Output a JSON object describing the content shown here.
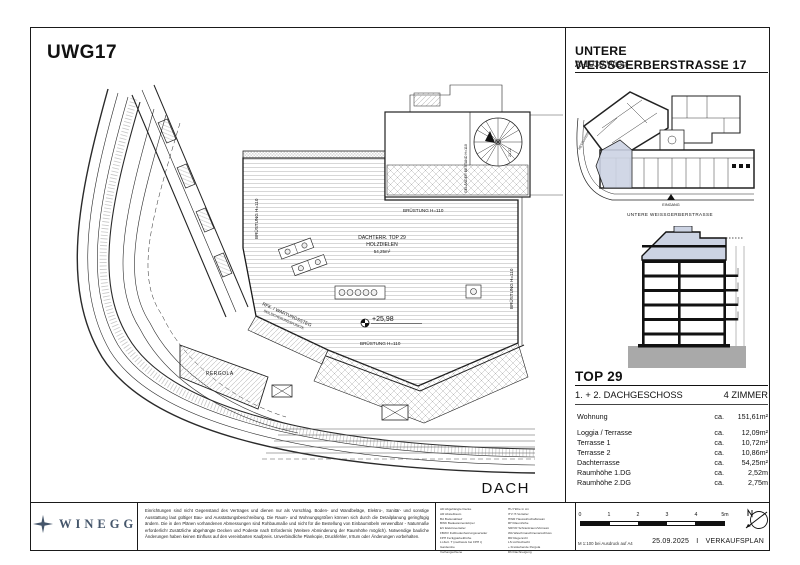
{
  "sheet": {
    "project_code": "UWG17",
    "header": {
      "title": "UNTERE WEISSGERBERSTRASSE 17",
      "subtitle": "A-1030 Wien"
    }
  },
  "main_plan": {
    "plan_name": "DACH",
    "labels": {
      "area_title": "DACHTERR. TOP 29",
      "area_sub": "HOLZDIELEN",
      "area_size": "54,25m²",
      "level": "+25,98",
      "parapet": "BRÜSTUNG H=110",
      "railing": "GELÄNDER BESTAND H=110",
      "stair_note": "21,22",
      "walkway1": "RFK. / WARTUNGSSTEG",
      "walkway2": "SEILSICHERUNGSPUNKTE",
      "pergola": "PERGOLA"
    }
  },
  "site_plan": {
    "entrance": "EINGANG",
    "street": "UNTERE WEISSGERBERSTRASSE",
    "side_street": "HETZGASSE"
  },
  "unit": {
    "name": "TOP 29",
    "floor": "1. + 2. DACHGESCHOSS",
    "rooms": "4 ZIMMER",
    "rows": [
      {
        "label": "Wohnung",
        "ca": "ca.",
        "value": "151,61m²"
      },
      {
        "label": "Loggia / Terrasse",
        "ca": "ca.",
        "value": "12,09m²"
      },
      {
        "label": "Terrasse 1",
        "ca": "ca.",
        "value": "10,72m²"
      },
      {
        "label": "Terrasse 2",
        "ca": "ca.",
        "value": "10,86m²"
      },
      {
        "label": "Dachterrasse",
        "ca": "ca.",
        "value": "54,25m²"
      },
      {
        "label": "Raumhöhe 1.DG",
        "ca": "ca.",
        "value": "2,52m"
      },
      {
        "label": "Raumhöhe 2.DG",
        "ca": "ca.",
        "value": "2,75m"
      }
    ]
  },
  "footer": {
    "brand": "WINEGG",
    "disclaimer": "Einrichtungen sind nicht Gegenstand des Vertrages und dienen nur als Vorschlag. Boden- und Wandbeläge, Elektro-, Sanitär- und sonstige Ausstattung laut gültiger Bau- und Ausstattungsbeschreibung. Die Raum- und Wohnungsgrößen können sich durch die Detailplanung geringfügig ändern. Die in den Plänen vorhandenen Abmessungen sind Rohbaumaße und nicht für die Bestellung von Einbaumöbeln verwendbar - Naturmaße erforderlich! Zusätzliche abgehängte Decken und Podeste nach Erfordernis (Weitere Abminderung der Raumhöhe möglich). Notwendige bauliche Änderungen haben keinen Einfluss auf den vereinbarten Kaufpreis. Unverbindliche Plankopie, Druckfehler, Irrtum oder Änderungen vorbehalten.",
    "legend_col1": [
      "AD   Abgehängte Decke",
      "AR   Abstellraum",
      "BA   Bodenablauf",
      "BWK  Badewannenkörper",
      "EV   Elektroverteiler",
      "FBWV Fußbodenheizungsverteiler",
      "FPH  Fertigparketthöhe",
      "Lt.Zert. T (nachweis bei FPH t)",
      "Garderobe",
      "Vorhangschiene"
    ],
    "legend_col2": [
      "HU   Höhe in cm",
      "ITV  IT-Verteiler",
      "HWR  Hauswirtschaftsraum",
      "RH   Raumhöhe",
      "SR/VR Schrankraum/Vorraum",
      "WA   Waschmaschinenanschluss",
      "RR   Regenrohr",
      "LS   Lichtschacht",
      "+    Freistehende Pergola",
      "DN   Dachneigung"
    ],
    "scale_ticks": [
      "0",
      "1",
      "2",
      "3",
      "4",
      "5m"
    ],
    "scale_note": "M 1:100 bei Ausdruck auf A4",
    "date": "25.09.2025",
    "sep": "I",
    "doc_type": "VERKAUFSPLAN"
  },
  "colors": {
    "highlight": "#ccd3e3",
    "line": "#1a1a1a",
    "ground": "#a9a9a9"
  }
}
